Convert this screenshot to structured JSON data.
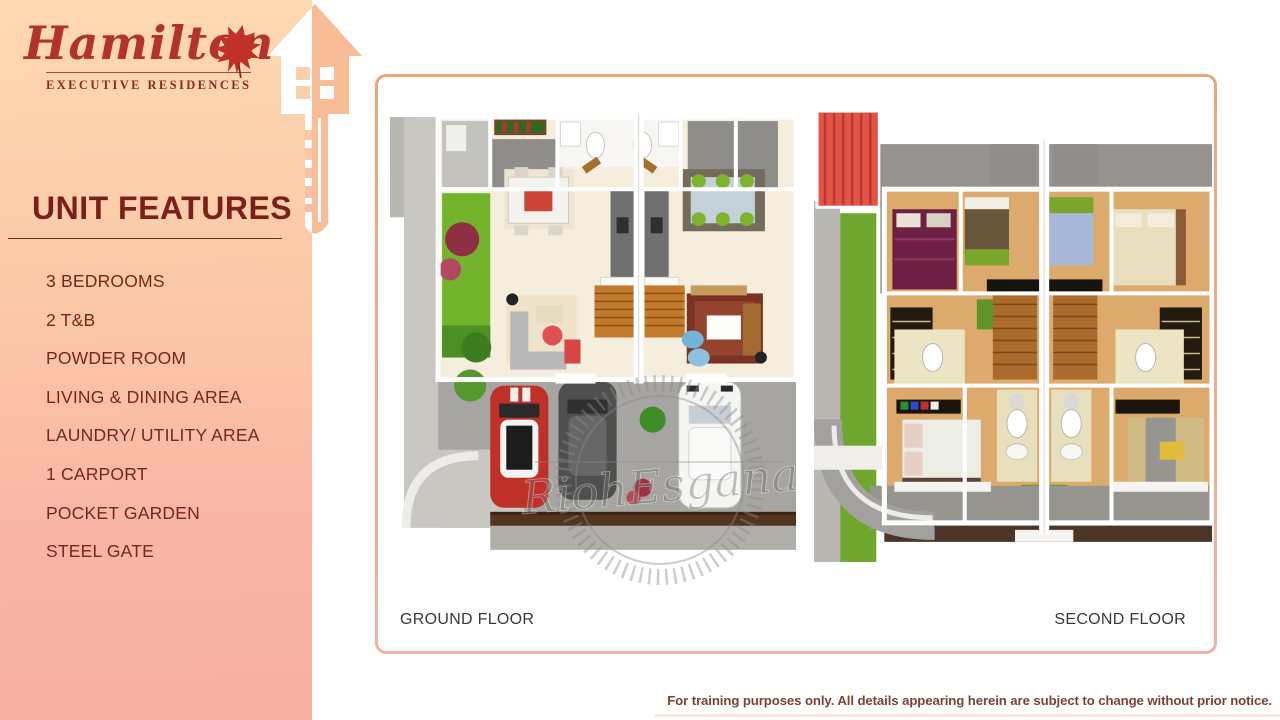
{
  "slide": {
    "brand": {
      "name": "Hamilton",
      "tagline": "EXECUTIVE RESIDENCES"
    },
    "title": "UNIT FEATURES",
    "features": [
      "3 BEDROOMS",
      "2 T&B",
      "POWDER ROOM",
      "LIVING & DINING AREA",
      "LAUNDRY/ UTILITY AREA",
      "1 CARPORT",
      "POCKET GARDEN",
      "STEEL GATE"
    ],
    "floor_plans": {
      "ground": {
        "label": "GROUND FLOOR"
      },
      "second": {
        "label": "SECOND FLOOR"
      }
    },
    "watermark": {
      "text": "RiohEsgana"
    },
    "disclaimer": "For training purposes only. All details appearing herein are subject to change without prior notice.",
    "colors": {
      "accent_maroon": "#7c1f1a",
      "logo_red": "#b2332a",
      "sidebar_top": "#fdd9b3",
      "sidebar_bottom": "#f8afa2",
      "frame_orange": "#eaa777",
      "frame_pink": "#f4b0a6",
      "disclaimer_brown": "#7c4437",
      "garden_green": "#74b32c",
      "roof_red": "#e15448"
    }
  }
}
